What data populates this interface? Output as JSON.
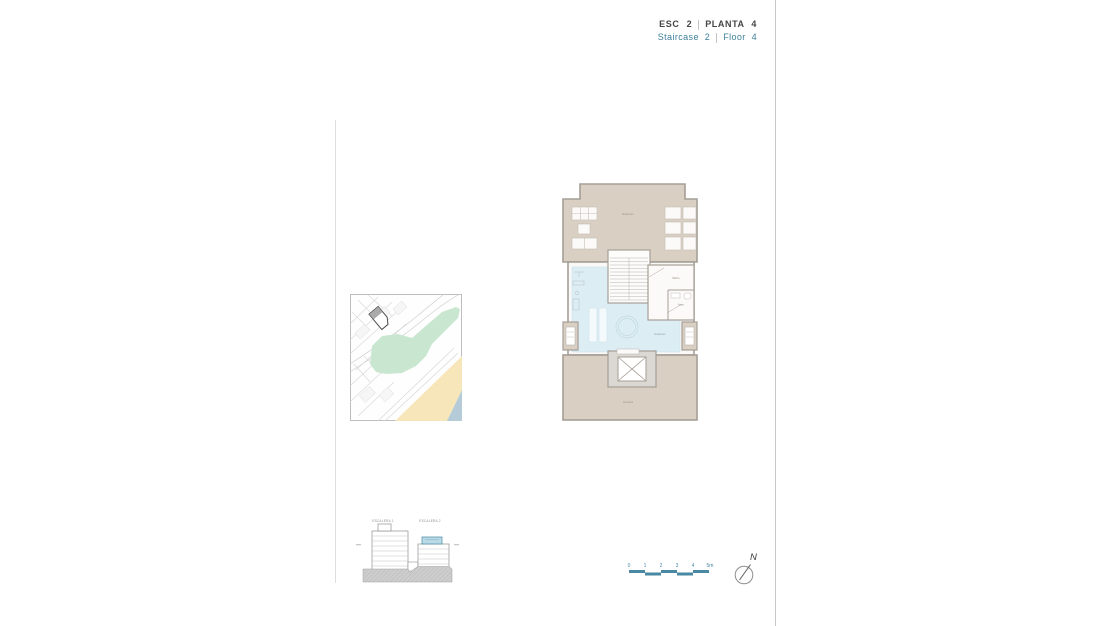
{
  "header": {
    "esc": "ESC 2",
    "planta": "PLANTA 4",
    "staircase": "Staircase 2",
    "floor": "Floor 4"
  },
  "floor_plan": {
    "top_terrace_label": "Solarium",
    "solarium_label": "Solarium",
    "bathroom_label": "Baño",
    "toilet_label": "Aseo",
    "bottom_terrace_label": "Terraza"
  },
  "elevation": {
    "left_building_label": "ESCALERA 1",
    "right_building_label": "ESCALERA 2"
  },
  "scale_bar": {
    "ticks": [
      "0",
      "1",
      "2",
      "3",
      "4",
      "5m"
    ]
  },
  "compass": {
    "north": "N"
  },
  "colors": {
    "accent_teal": "#3e7f9a",
    "scale_bar_teal": "#4a89a3",
    "terrace_beige": "#d9cfc2",
    "wall_gray": "#a59f96",
    "pool_blue": "#dceef4",
    "highlight_floor_teal": "#b9dbe7",
    "map_green": "#c9e7d0",
    "map_sand": "#f6e6ba",
    "map_sea": "#b6cbd8",
    "text_dark": "#454545"
  }
}
